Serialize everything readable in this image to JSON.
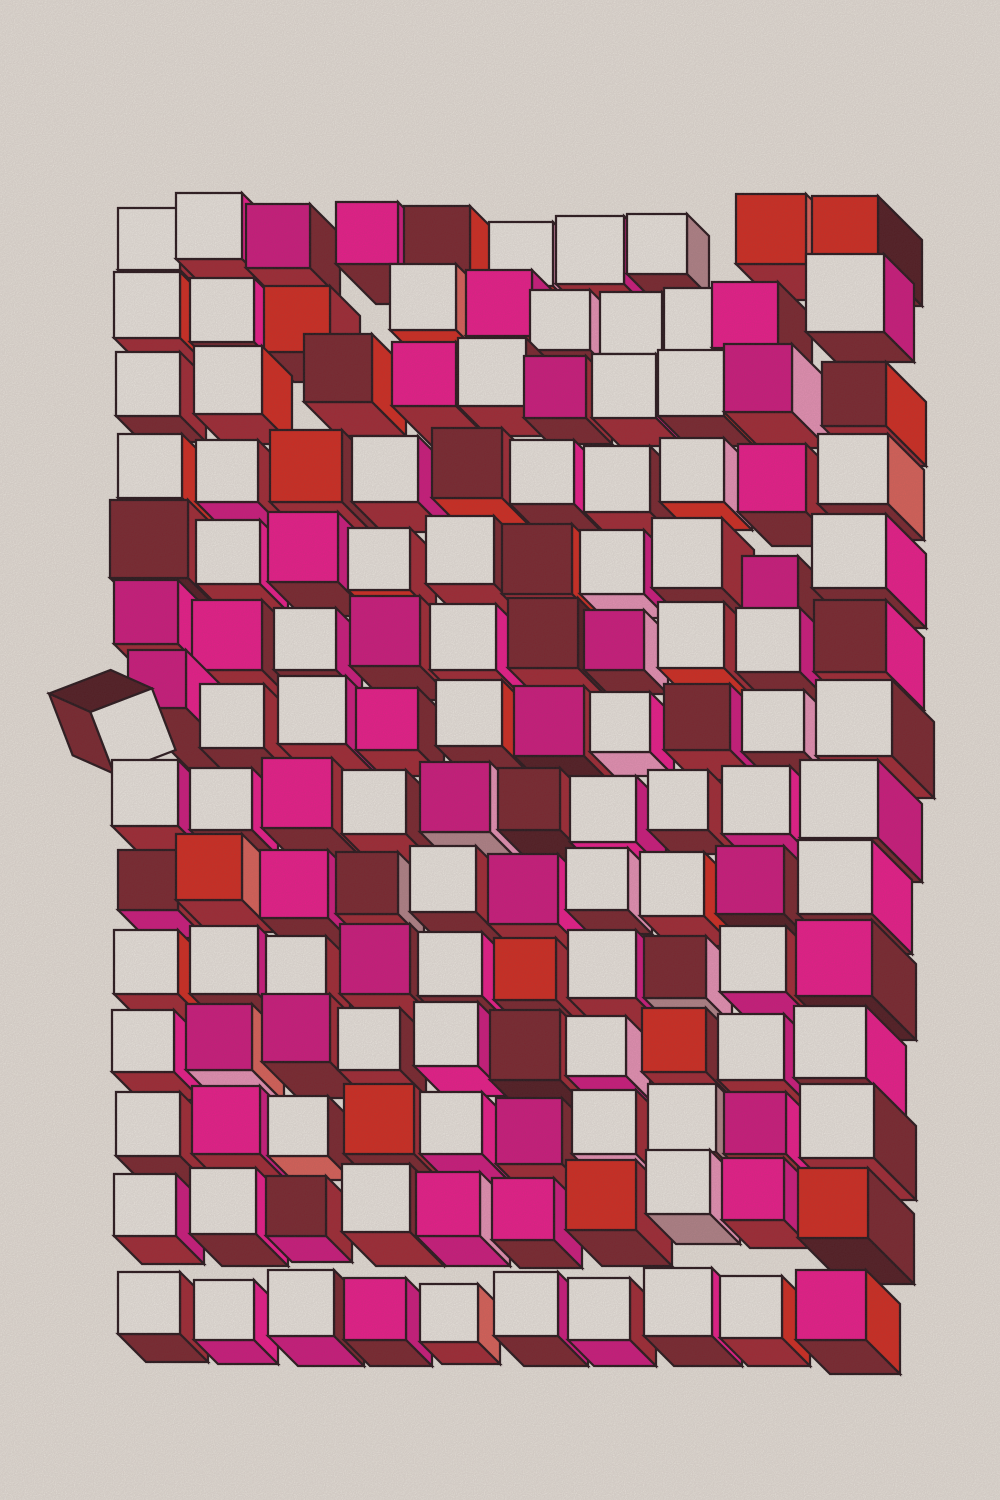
{
  "artwork": {
    "kind": "generative-cube-field",
    "canvas": {
      "width": 1000,
      "height": 1500
    },
    "style": {
      "paper_color": "#EEEAE2",
      "outline_color": "#231318",
      "outline_width": 2.25,
      "grain_opacity": 0.22
    },
    "palette": {
      "W": "#F2EFE8",
      "P": "#F2168E",
      "M": "#D31480",
      "R": "#D7271C",
      "S": "#E06158",
      "C": "#A32531",
      "K": "#7A222B",
      "B": "#4F171E",
      "L": "#EE95BB",
      "D": "#B5858B"
    },
    "cube_fields": [
      "x",
      "y",
      "size",
      "depth",
      "front_color",
      "right_color",
      "bottom_color",
      "rotation_deg",
      "mirrored_extrusion"
    ],
    "cubes": [
      [
        118,
        208,
        62,
        24,
        "W",
        "C",
        "K"
      ],
      [
        176,
        193,
        66,
        30,
        "W",
        "P",
        "C"
      ],
      [
        246,
        204,
        64,
        30,
        "M",
        "K",
        "C"
      ],
      [
        336,
        202,
        62,
        40,
        "P",
        "M",
        "K"
      ],
      [
        404,
        206,
        66,
        36,
        "K",
        "R",
        "C"
      ],
      [
        489,
        222,
        64,
        26,
        "W",
        "L",
        "R"
      ],
      [
        556,
        216,
        68,
        28,
        "W",
        "M",
        "C"
      ],
      [
        627,
        214,
        60,
        22,
        "W",
        "D",
        "K"
      ],
      [
        736,
        194,
        70,
        36,
        "R",
        "S",
        "C"
      ],
      [
        812,
        196,
        66,
        44,
        "R",
        "B",
        "K"
      ],
      [
        114,
        272,
        66,
        28,
        "W",
        "R",
        "C"
      ],
      [
        190,
        278,
        64,
        26,
        "W",
        "P",
        "K"
      ],
      [
        264,
        286,
        66,
        30,
        "R",
        "C",
        "K"
      ],
      [
        390,
        264,
        66,
        30,
        "W",
        "S",
        "R"
      ],
      [
        466,
        270,
        66,
        36,
        "P",
        "M",
        "C"
      ],
      [
        530,
        290,
        60,
        24,
        "W",
        "L",
        "K"
      ],
      [
        600,
        292,
        62,
        26,
        "W",
        "C",
        "K"
      ],
      [
        664,
        288,
        64,
        28,
        "W",
        "D",
        "C"
      ],
      [
        712,
        282,
        66,
        34,
        "P",
        "K",
        "M"
      ],
      [
        806,
        254,
        78,
        30,
        "W",
        "M",
        "K"
      ],
      [
        116,
        352,
        64,
        26,
        "W",
        "C",
        "K"
      ],
      [
        194,
        346,
        68,
        30,
        "W",
        "R",
        "C"
      ],
      [
        304,
        334,
        68,
        34,
        "K",
        "R",
        "C"
      ],
      [
        392,
        342,
        64,
        40,
        "P",
        "K",
        "C"
      ],
      [
        458,
        338,
        68,
        30,
        "W",
        "K",
        "C"
      ],
      [
        524,
        356,
        62,
        26,
        "M",
        "C",
        "K"
      ],
      [
        592,
        354,
        64,
        28,
        "W",
        "P",
        "C"
      ],
      [
        658,
        350,
        66,
        30,
        "W",
        "R",
        "K"
      ],
      [
        724,
        344,
        68,
        36,
        "M",
        "L",
        "C"
      ],
      [
        822,
        362,
        64,
        40,
        "K",
        "R",
        "C"
      ],
      [
        118,
        434,
        64,
        30,
        "W",
        "R",
        "C"
      ],
      [
        196,
        440,
        62,
        24,
        "W",
        "C",
        "M"
      ],
      [
        270,
        430,
        72,
        36,
        "R",
        "K",
        "C"
      ],
      [
        352,
        436,
        66,
        30,
        "W",
        "M",
        "C"
      ],
      [
        432,
        428,
        70,
        34,
        "K",
        "C",
        "R"
      ],
      [
        510,
        440,
        64,
        40,
        "W",
        "P",
        "K"
      ],
      [
        584,
        446,
        66,
        26,
        "W",
        "K",
        "C"
      ],
      [
        660,
        438,
        64,
        28,
        "W",
        "L",
        "R"
      ],
      [
        738,
        444,
        68,
        34,
        "P",
        "C",
        "K"
      ],
      [
        818,
        434,
        70,
        36,
        "W",
        "S",
        "K"
      ],
      [
        110,
        500,
        78,
        36,
        "K",
        "C",
        "B"
      ],
      [
        196,
        520,
        64,
        28,
        "W",
        "P",
        "C"
      ],
      [
        268,
        512,
        70,
        34,
        "P",
        "M",
        "K"
      ],
      [
        348,
        528,
        62,
        26,
        "W",
        "C",
        "R"
      ],
      [
        426,
        516,
        68,
        30,
        "W",
        "K",
        "C"
      ],
      [
        502,
        524,
        70,
        38,
        "K",
        "R",
        "C"
      ],
      [
        580,
        530,
        64,
        24,
        "W",
        "M",
        "L"
      ],
      [
        652,
        518,
        70,
        32,
        "W",
        "C",
        "K"
      ],
      [
        742,
        556,
        56,
        28,
        "M",
        "K",
        "C"
      ],
      [
        812,
        514,
        74,
        40,
        "W",
        "P",
        "K"
      ],
      [
        114,
        580,
        64,
        40,
        "M",
        "P",
        "C"
      ],
      [
        192,
        600,
        70,
        30,
        "P",
        "K",
        "C"
      ],
      [
        274,
        608,
        62,
        26,
        "W",
        "M",
        "K"
      ],
      [
        350,
        596,
        70,
        34,
        "M",
        "C",
        "K"
      ],
      [
        430,
        604,
        66,
        28,
        "W",
        "P",
        "C"
      ],
      [
        508,
        598,
        70,
        44,
        "K",
        "B",
        "C"
      ],
      [
        584,
        610,
        60,
        24,
        "M",
        "L",
        "K"
      ],
      [
        658,
        602,
        66,
        30,
        "W",
        "C",
        "R"
      ],
      [
        736,
        608,
        64,
        28,
        "W",
        "M",
        "K"
      ],
      [
        814,
        600,
        72,
        38,
        "K",
        "P",
        "C"
      ],
      [
        128,
        650,
        58,
        64,
        "M",
        "P",
        "K"
      ],
      [
        200,
        684,
        64,
        30,
        "W",
        "C",
        "K"
      ],
      [
        278,
        676,
        68,
        34,
        "W",
        "M",
        "C"
      ],
      [
        356,
        688,
        62,
        26,
        "P",
        "K",
        "C"
      ],
      [
        436,
        680,
        66,
        32,
        "W",
        "R",
        "K"
      ],
      [
        514,
        686,
        70,
        36,
        "M",
        "C",
        "B"
      ],
      [
        590,
        692,
        60,
        24,
        "W",
        "P",
        "L"
      ],
      [
        664,
        684,
        66,
        30,
        "K",
        "M",
        "C"
      ],
      [
        742,
        690,
        62,
        28,
        "W",
        "L",
        "K"
      ],
      [
        816,
        680,
        76,
        42,
        "W",
        "K",
        "C"
      ],
      [
        100,
        698,
        66,
        32,
        "W",
        "B",
        "K",
        -21,
        1
      ],
      [
        112,
        760,
        66,
        30,
        "W",
        "M",
        "C"
      ],
      [
        190,
        768,
        62,
        26,
        "W",
        "P",
        "K"
      ],
      [
        262,
        758,
        70,
        36,
        "P",
        "C",
        "K"
      ],
      [
        342,
        770,
        64,
        28,
        "W",
        "K",
        "C"
      ],
      [
        420,
        762,
        70,
        34,
        "M",
        "L",
        "D"
      ],
      [
        498,
        768,
        62,
        40,
        "K",
        "C",
        "B"
      ],
      [
        570,
        776,
        66,
        30,
        "W",
        "M",
        "P"
      ],
      [
        648,
        770,
        60,
        24,
        "W",
        "C",
        "K"
      ],
      [
        722,
        766,
        68,
        34,
        "W",
        "P",
        "M"
      ],
      [
        800,
        760,
        78,
        44,
        "W",
        "M",
        "K"
      ],
      [
        118,
        850,
        60,
        28,
        "K",
        "C",
        "M"
      ],
      [
        176,
        834,
        66,
        32,
        "R",
        "S",
        "C"
      ],
      [
        260,
        850,
        68,
        34,
        "P",
        "M",
        "K"
      ],
      [
        336,
        852,
        62,
        26,
        "K",
        "D",
        "C"
      ],
      [
        410,
        846,
        66,
        30,
        "W",
        "C",
        "K"
      ],
      [
        488,
        854,
        70,
        36,
        "M",
        "P",
        "C"
      ],
      [
        566,
        848,
        62,
        24,
        "W",
        "L",
        "K"
      ],
      [
        640,
        852,
        64,
        30,
        "W",
        "R",
        "C"
      ],
      [
        716,
        846,
        68,
        34,
        "M",
        "K",
        "B"
      ],
      [
        798,
        840,
        74,
        40,
        "W",
        "P",
        "K"
      ],
      [
        114,
        930,
        64,
        30,
        "W",
        "R",
        "C"
      ],
      [
        190,
        926,
        68,
        34,
        "W",
        "M",
        "K"
      ],
      [
        266,
        936,
        60,
        24,
        "W",
        "C",
        "P"
      ],
      [
        340,
        924,
        70,
        36,
        "M",
        "K",
        "C"
      ],
      [
        418,
        932,
        64,
        28,
        "W",
        "P",
        "K"
      ],
      [
        494,
        938,
        62,
        30,
        "R",
        "C",
        "K"
      ],
      [
        568,
        930,
        68,
        34,
        "W",
        "M",
        "C"
      ],
      [
        644,
        936,
        62,
        26,
        "K",
        "L",
        "D"
      ],
      [
        720,
        926,
        66,
        32,
        "W",
        "C",
        "M"
      ],
      [
        796,
        920,
        76,
        44,
        "P",
        "K",
        "B"
      ],
      [
        112,
        1010,
        62,
        28,
        "W",
        "P",
        "C"
      ],
      [
        186,
        1004,
        66,
        32,
        "M",
        "S",
        "L"
      ],
      [
        262,
        994,
        68,
        36,
        "M",
        "C",
        "K"
      ],
      [
        338,
        1008,
        62,
        26,
        "W",
        "K",
        "C"
      ],
      [
        414,
        1002,
        64,
        30,
        "W",
        "M",
        "P"
      ],
      [
        490,
        1010,
        70,
        36,
        "K",
        "C",
        "B"
      ],
      [
        566,
        1016,
        60,
        24,
        "W",
        "L",
        "M"
      ],
      [
        642,
        1008,
        64,
        30,
        "R",
        "K",
        "C"
      ],
      [
        718,
        1014,
        66,
        32,
        "W",
        "M",
        "C"
      ],
      [
        794,
        1006,
        72,
        40,
        "W",
        "P",
        "K"
      ],
      [
        116,
        1092,
        64,
        30,
        "W",
        "C",
        "K"
      ],
      [
        192,
        1086,
        68,
        34,
        "P",
        "M",
        "C"
      ],
      [
        268,
        1096,
        60,
        24,
        "W",
        "K",
        "S"
      ],
      [
        344,
        1084,
        70,
        36,
        "R",
        "C",
        "K"
      ],
      [
        420,
        1092,
        62,
        28,
        "W",
        "P",
        "M"
      ],
      [
        496,
        1098,
        66,
        32,
        "M",
        "K",
        "C"
      ],
      [
        572,
        1090,
        64,
        30,
        "W",
        "C",
        "L"
      ],
      [
        648,
        1084,
        68,
        34,
        "W",
        "D",
        "K"
      ],
      [
        724,
        1092,
        62,
        26,
        "M",
        "P",
        "C"
      ],
      [
        800,
        1084,
        74,
        42,
        "W",
        "K",
        "C"
      ],
      [
        114,
        1174,
        62,
        28,
        "W",
        "M",
        "C"
      ],
      [
        190,
        1168,
        66,
        32,
        "W",
        "P",
        "K"
      ],
      [
        266,
        1176,
        60,
        26,
        "K",
        "C",
        "M"
      ],
      [
        342,
        1164,
        68,
        34,
        "W",
        "K",
        "C"
      ],
      [
        416,
        1172,
        64,
        30,
        "P",
        "L",
        "M"
      ],
      [
        492,
        1178,
        62,
        28,
        "P",
        "M",
        "K"
      ],
      [
        566,
        1160,
        70,
        36,
        "R",
        "C",
        "K"
      ],
      [
        646,
        1150,
        64,
        30,
        "W",
        "L",
        "D"
      ],
      [
        722,
        1158,
        62,
        28,
        "P",
        "M",
        "C"
      ],
      [
        798,
        1168,
        70,
        46,
        "R",
        "K",
        "B"
      ],
      [
        118,
        1272,
        62,
        28,
        "W",
        "C",
        "K"
      ],
      [
        194,
        1280,
        60,
        24,
        "W",
        "P",
        "M"
      ],
      [
        268,
        1270,
        66,
        30,
        "W",
        "K",
        "M"
      ],
      [
        344,
        1278,
        62,
        26,
        "P",
        "M",
        "K"
      ],
      [
        420,
        1284,
        58,
        22,
        "W",
        "S",
        "C"
      ],
      [
        494,
        1272,
        64,
        30,
        "W",
        "M",
        "K"
      ],
      [
        568,
        1278,
        62,
        26,
        "W",
        "C",
        "M"
      ],
      [
        644,
        1268,
        68,
        30,
        "W",
        "P",
        "K"
      ],
      [
        720,
        1276,
        62,
        28,
        "W",
        "R",
        "C"
      ],
      [
        796,
        1270,
        70,
        34,
        "P",
        "R",
        "K"
      ]
    ]
  }
}
